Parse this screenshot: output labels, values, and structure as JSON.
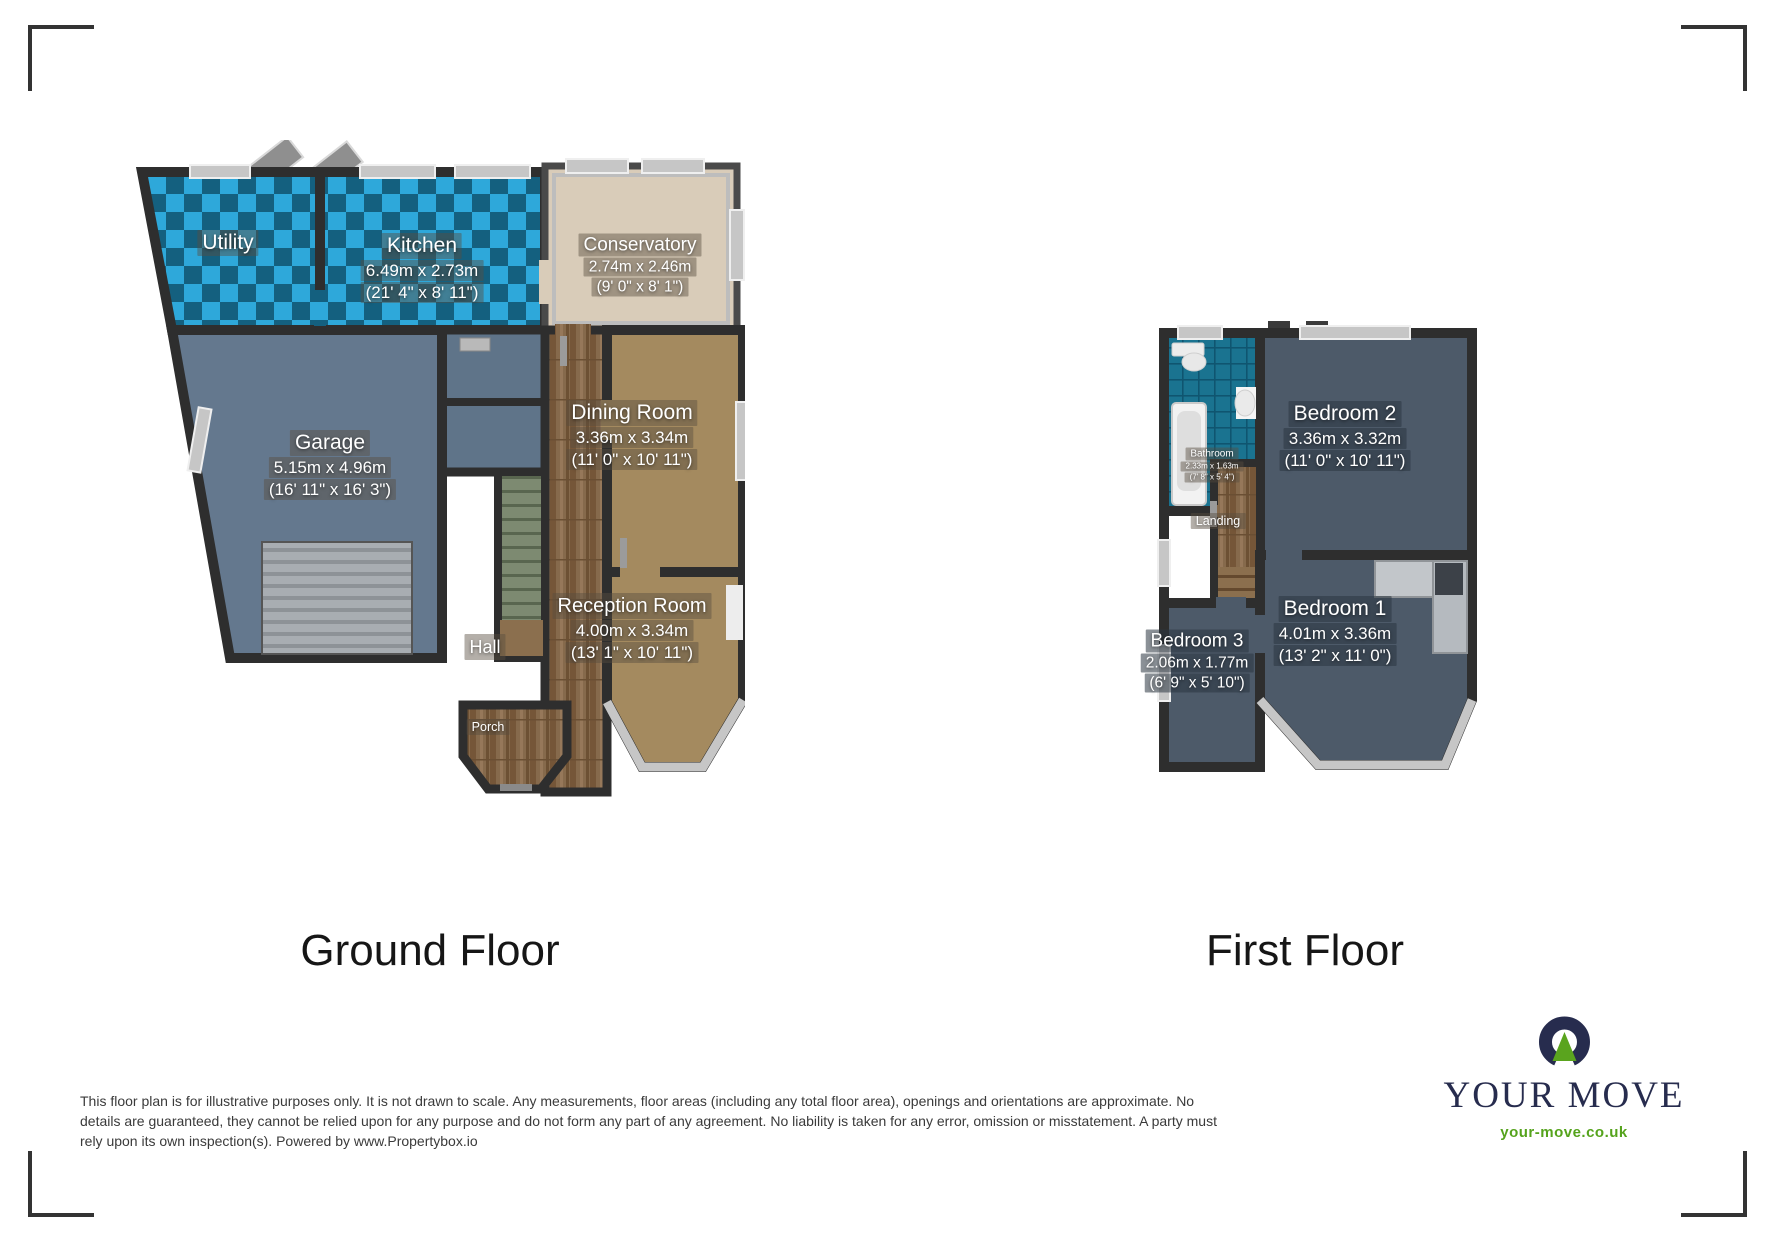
{
  "floors": [
    {
      "label": "Ground Floor",
      "rooms": [
        {
          "name": "Utility"
        },
        {
          "name": "Kitchen",
          "dims_m": "6.49m x 2.73m",
          "dims_ft": "(21' 4\" x 8' 11\")"
        },
        {
          "name": "Conservatory",
          "dims_m": "2.74m x 2.46m",
          "dims_ft": "(9' 0\" x 8' 1\")"
        },
        {
          "name": "Garage",
          "dims_m": "5.15m x 4.96m",
          "dims_ft": "(16' 11\" x 16' 3\")"
        },
        {
          "name": "Dining Room",
          "dims_m": "3.36m x 3.34m",
          "dims_ft": "(11' 0\" x 10' 11\")"
        },
        {
          "name": "Hall"
        },
        {
          "name": "Reception Room",
          "dims_m": "4.00m x 3.34m",
          "dims_ft": "(13' 1\" x 10' 11\")"
        },
        {
          "name": "Porch"
        }
      ]
    },
    {
      "label": "First Floor",
      "rooms": [
        {
          "name": "Bathroom",
          "dims_m": "2.33m x 1.63m",
          "dims_ft": "(7' 8\" x 5' 4\")"
        },
        {
          "name": "Bedroom 2",
          "dims_m": "3.36m x 3.32m",
          "dims_ft": "(11' 0\" x 10' 11\")"
        },
        {
          "name": "Landing"
        },
        {
          "name": "Bedroom 3",
          "dims_m": "2.06m x 1.77m",
          "dims_ft": "(6' 9\" x 5' 10\")"
        },
        {
          "name": "Bedroom 1",
          "dims_m": "4.01m x 3.36m",
          "dims_ft": "(13' 2\" x 11' 0\")"
        }
      ]
    }
  ],
  "disclaimer": {
    "line1": "This floor plan is for illustrative purposes only. It is not drawn to scale. Any measurements, floor areas (including any total floor area), openings and orientations are approximate. No",
    "line2": "details are guaranteed, they cannot be relied upon for any purpose and do not form any part of any agreement. No liability is taken for any error, omission or misstatement. A party must",
    "line3": "rely upon its own inspection(s). Powered by www.Propertybox.io"
  },
  "brand": {
    "name": "YOUR MOVE",
    "url": "your-move.co.uk",
    "navy": "#272c4e",
    "green": "#5aa41e"
  },
  "colors": {
    "wall": "#2e2e2e",
    "checker_light": "#2ea8da",
    "checker_dark": "#14607f",
    "bedroom_floor": "#4d5a69",
    "carpet": "#a48a5f",
    "conservatory_floor": "#d9ccb9",
    "garage_floor": "#64788e",
    "bathroom_tile": "#1a7390",
    "window_gray": "#c6c6c6"
  }
}
